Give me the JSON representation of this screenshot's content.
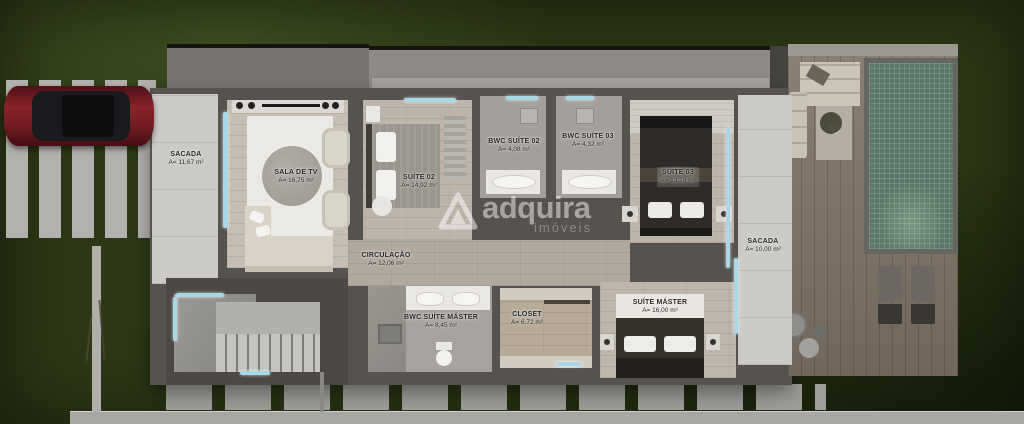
{
  "watermark": {
    "brand": "adquira",
    "subtitle": "imóveis"
  },
  "rooms": [
    {
      "name": "SACADA",
      "area": "A= 11,67 m²"
    },
    {
      "name": "SALA DE TV",
      "area": "A= 16,75 m²"
    },
    {
      "name": "SUÍTE 02",
      "area": "A= 14,92 m²"
    },
    {
      "name": "BWC SUÍTE 02",
      "area": "A= 4,08 m²"
    },
    {
      "name": "BWC SUÍTE 03",
      "area": "A= 4,32 m²"
    },
    {
      "name": "SUÍTE 03",
      "area": "A= 13,28 m²"
    },
    {
      "name": "SACADA",
      "area": "A= 10,00 m²"
    },
    {
      "name": "CIRCULAÇÃO",
      "area": "A= 12,06 m²"
    },
    {
      "name": "BWC SUÍTE MÁSTER",
      "area": "A= 8,45 m²"
    },
    {
      "name": "CLOSET",
      "area": "A= 6,72 m²"
    },
    {
      "name": "SUÍTE MÁSTER",
      "area": "A= 16,00 m²"
    }
  ],
  "colors": {
    "grass": "#2c3816",
    "wall": "#56534e",
    "floor-wood": "#beb5aa",
    "floor-stone": "#cbcac6",
    "glass": "#a7d7e8",
    "pool": "#5a7767",
    "deck": "#837869",
    "car": "#7c2026",
    "label": "#2b2a27",
    "paver": "#b2b1ad"
  }
}
